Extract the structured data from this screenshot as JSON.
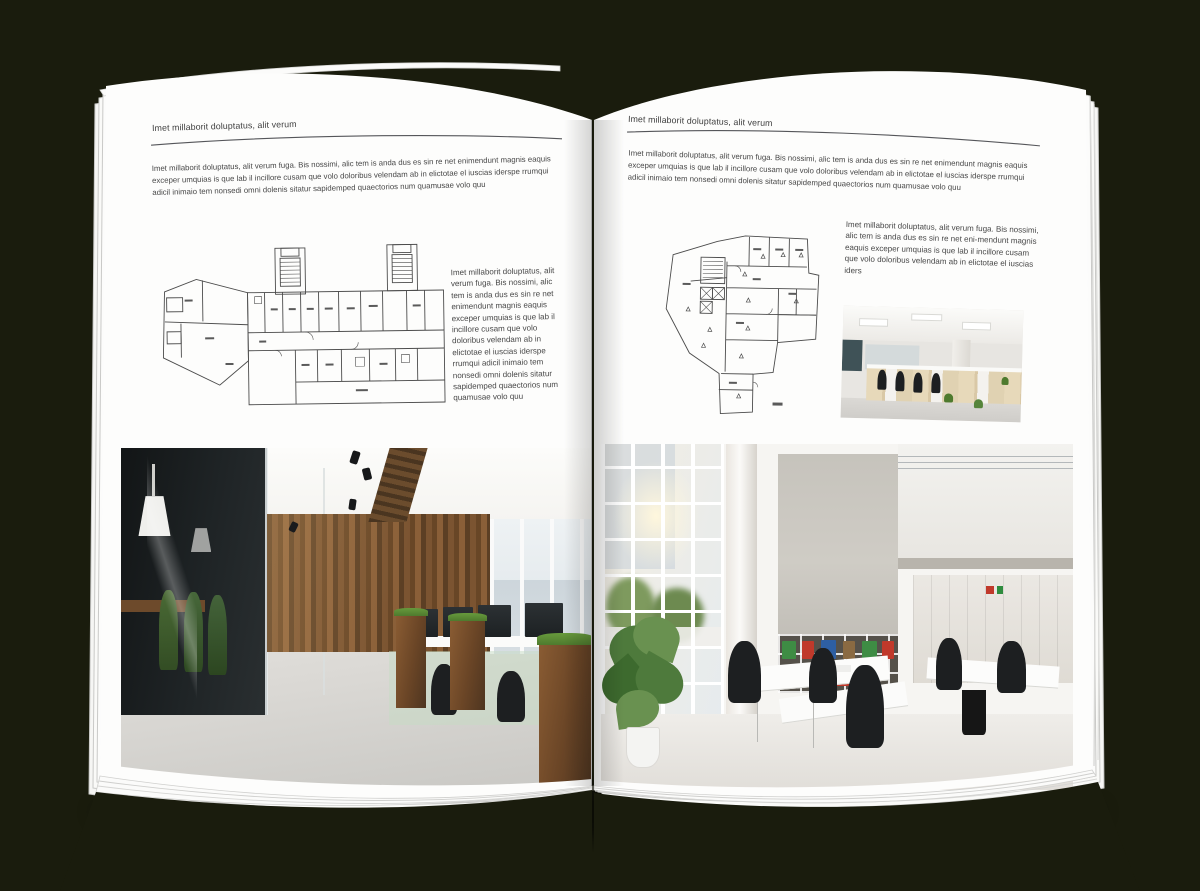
{
  "palette": {
    "background": "#1a1c0d",
    "page": "#fdfdfc",
    "page_edge_line": "#cfcfcd",
    "heading_ink": "#3d3d3d",
    "body_ink": "#474747",
    "header_rule": "#55565a",
    "plan_ink": "#4c4c4c",
    "wood": "#7b5431",
    "wood_dark": "#4e3520",
    "foliage": "#4e7a2e",
    "dark_glass": "#1b1e1f",
    "light_floor": "#d8d6d2",
    "concrete": "#cac7c0",
    "binder_green": "#3e8c44",
    "binder_red": "#c0392b",
    "binder_blue": "#2e5fa3"
  },
  "left_page": {
    "header": "Imet millaborit doluptatus, alit verum",
    "intro": "Imet millaborit doluptatus, alit verum fuga. Bis nossimi, alic tem is anda dus es sin re net enimendunt magnis eaquis exceper umquias is que lab il incillore cusam que volo doloribus velendam ab in elictotae el iuscias iderspe rrumqui adicil inimaio tem nonsedi omni dolenis sitatur sapidemped quaectorios num quamusae volo quu",
    "caption": "Imet millaborit doluptatus, alit verum fuga. Bis nossimi, alic tem is anda dus es sin re net enimendunt magnis eaquis exceper umquias is que lab il incillore cusam que volo doloribus velendam ab in elictotae el iuscias iderspe rrumqui adicil inimaio tem nonsedi omni dolenis sitatur sapidemped quaectorios num quamusae volo quu"
  },
  "right_page": {
    "header": "Imet millaborit doluptatus, alit verum",
    "intro": "Imet millaborit doluptatus, alit verum fuga. Bis nossimi, alic tem is anda dus es sin re net enimendunt magnis eaquis exceper umquias is que lab il incillore cusam que volo doloribus velendam ab in elictotae el iuscias iderspe rrumqui adicil inimaio tem nonsedi omni dolenis sitatur sapidemped quaectorios num quamusae volo quu",
    "caption": "Imet millaborit doluptatus, alit verum fuga. Bis nossimi, alic tem is anda dus es sin re net eni-mendunt magnis eaquis exceper umquias is que lab il incillore cusam que volo doloribus velendam ab in elictotae el iuscias iders"
  }
}
